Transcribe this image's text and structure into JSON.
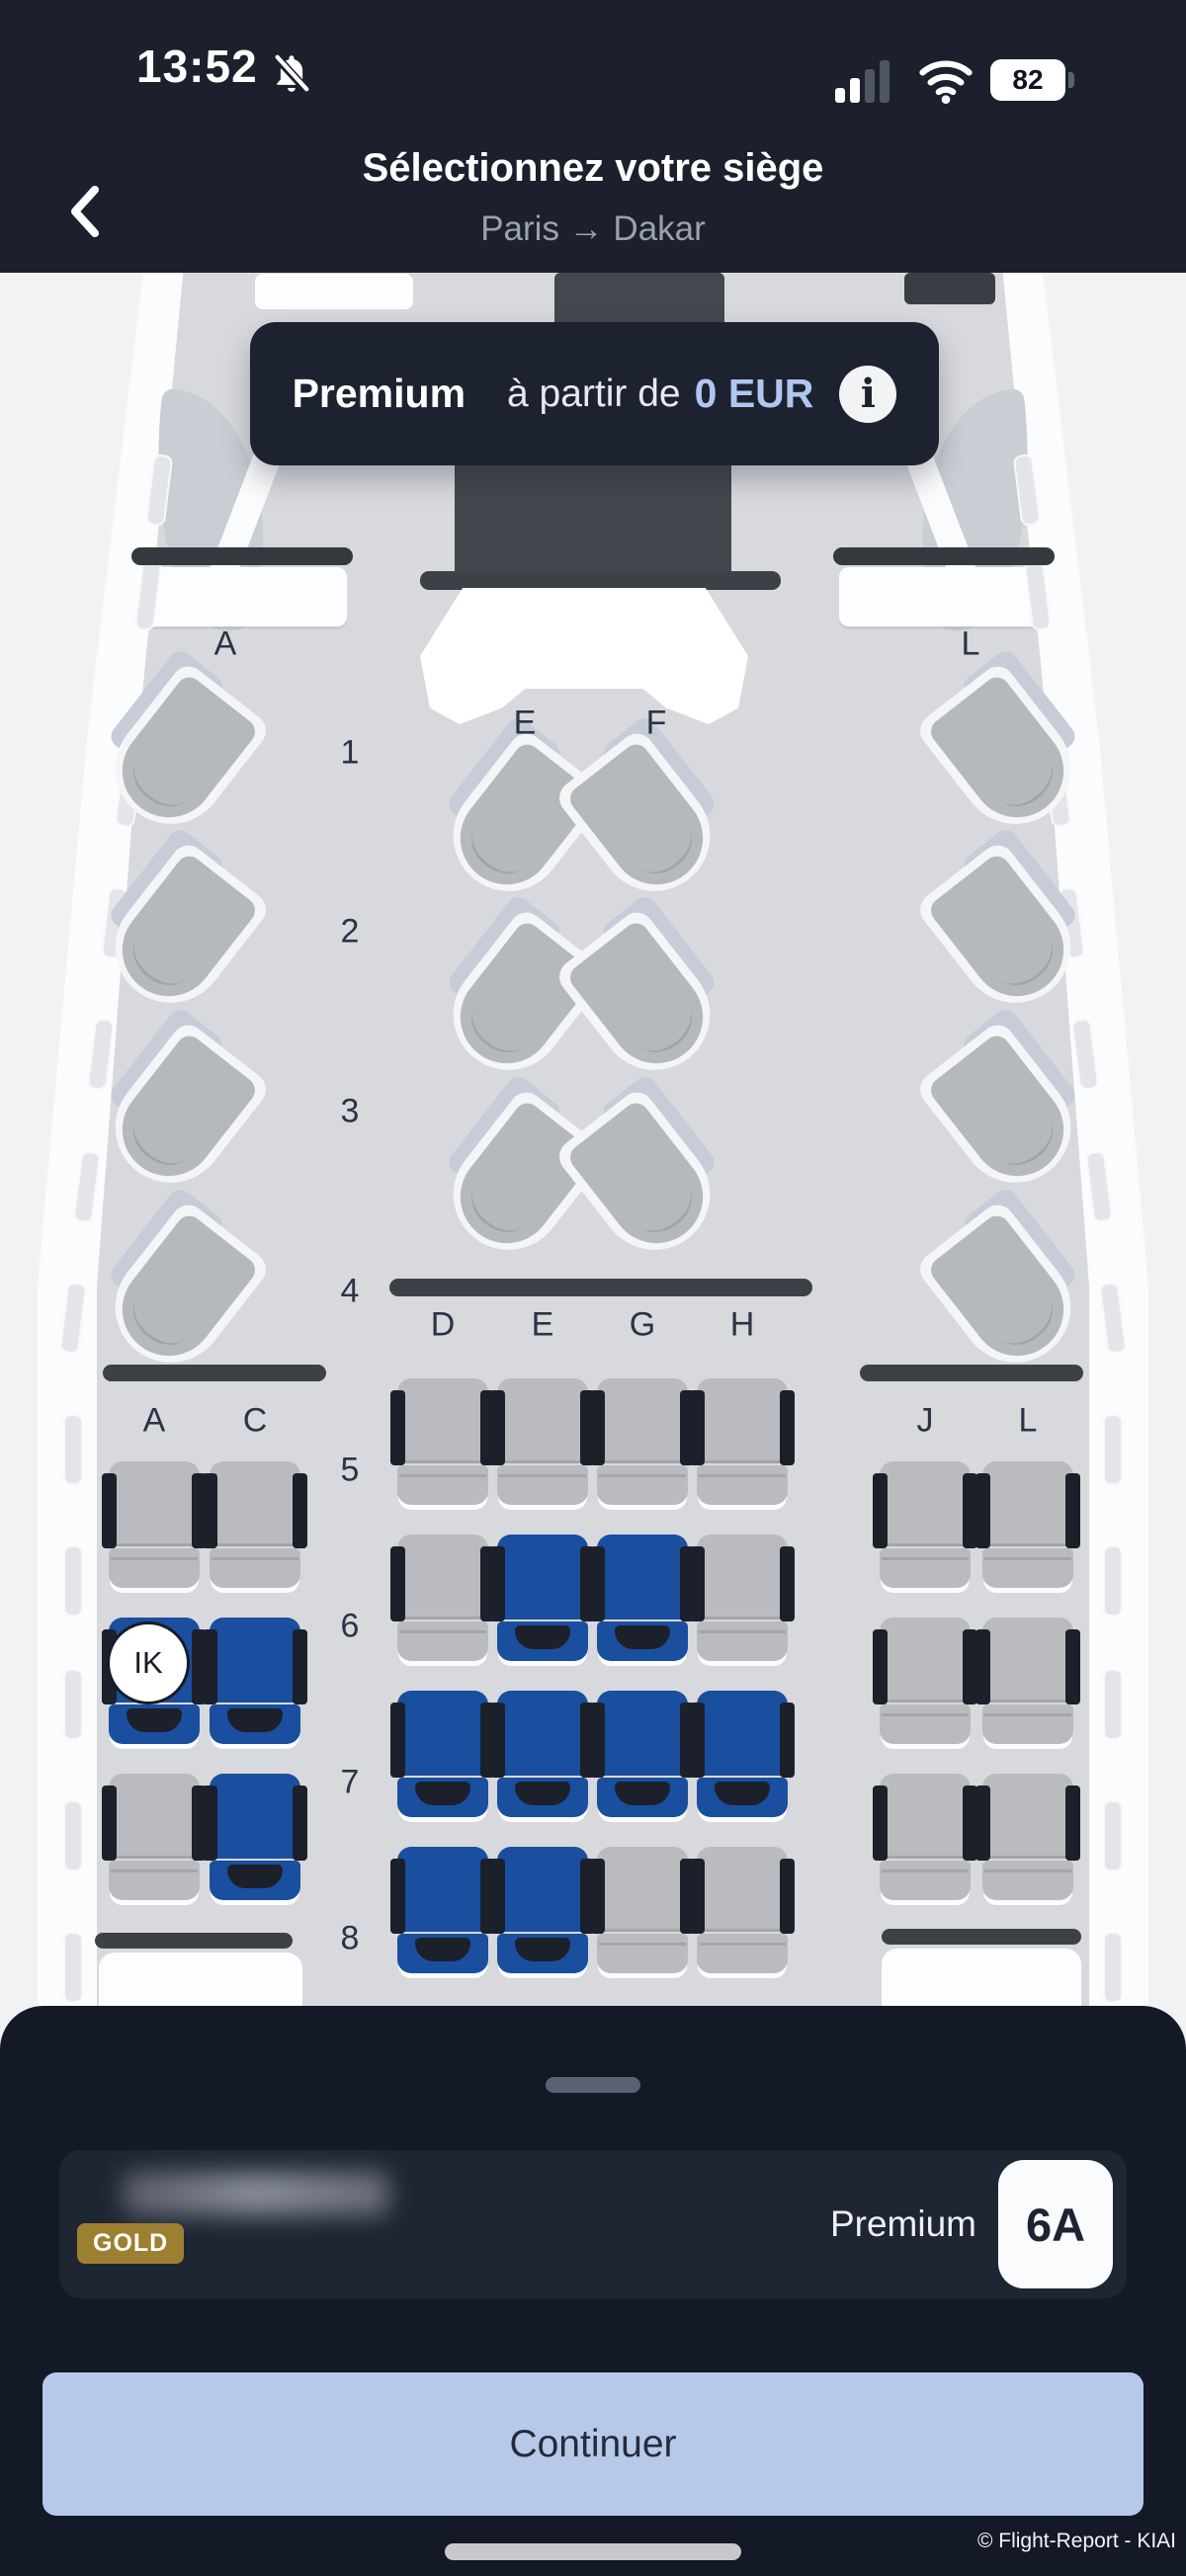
{
  "colors": {
    "header_bg": "#1b202c",
    "sheet_bg": "#141927",
    "card_bg": "#1e2533",
    "banner_bg": "#1d2230",
    "seat_available": "#1a4e9e",
    "seat_occupied": "#b9bbbe",
    "seat_dark": "#1b202b",
    "price_accent": "#b0c7ee",
    "gold_badge": "#9d7f31",
    "continue_bg": "#b7c9e9",
    "cabin": "#d7d9dd",
    "wall": "#fbfcfd",
    "exterior": "#f1f2f4",
    "divider": "#3d4147",
    "monument": "#44484e"
  },
  "status_bar": {
    "time": "13:52",
    "battery_level": "82",
    "icons": [
      "notifications-off-icon",
      "cellular-signal-icon",
      "wifi-icon",
      "battery-icon"
    ]
  },
  "header": {
    "back_icon": "chevron-left-icon",
    "title": "Sélectionnez votre siège",
    "route_from": "Paris",
    "route_arrow": "→",
    "route_to": "Dakar"
  },
  "banner": {
    "cabin_class": "Premium",
    "price_prefix": "à partir de",
    "price": "0 EUR",
    "info_icon": "info-icon",
    "info_glyph": "i"
  },
  "seatmap": {
    "business": {
      "left_label": "A",
      "center_labels": [
        "E",
        "F"
      ],
      "right_label": "L",
      "rows": [
        {
          "num": "1",
          "left": 1,
          "center": 1,
          "right": 1
        },
        {
          "num": "2",
          "left": 1,
          "center": 1,
          "right": 1
        },
        {
          "num": "3",
          "left": 1,
          "center": 1,
          "right": 1
        },
        {
          "num": "4",
          "left": 1,
          "center": 0,
          "right": 1
        }
      ]
    },
    "premium": {
      "left_labels": [
        "A",
        "C"
      ],
      "center_labels": [
        "D",
        "E",
        "G",
        "H"
      ],
      "right_labels": [
        "J",
        "L"
      ],
      "rows": [
        {
          "num": "5",
          "left": [
            "occupied",
            "occupied"
          ],
          "center": [
            "occupied",
            "occupied",
            "occupied",
            "occupied"
          ],
          "right": [
            "occupied",
            "occupied"
          ]
        },
        {
          "num": "6",
          "left": [
            "selected",
            "available"
          ],
          "center": [
            "occupied",
            "available",
            "available",
            "occupied"
          ],
          "right": [
            "occupied",
            "occupied"
          ]
        },
        {
          "num": "7",
          "left": [
            "occupied",
            "available"
          ],
          "center": [
            "available",
            "available",
            "available",
            "available"
          ],
          "right": [
            "occupied",
            "occupied"
          ]
        },
        {
          "num": "8",
          "left": null,
          "center": [
            "available",
            "available",
            "occupied",
            "occupied"
          ],
          "right": null
        }
      ],
      "selected_seat_badge": "IK"
    }
  },
  "bottom_sheet": {
    "passenger": {
      "tier_badge": "GOLD",
      "cabin_class": "Premium",
      "seat_number": "6A"
    },
    "continue_label": "Continuer"
  },
  "footer": {
    "credit": "© Flight-Report - KIAI"
  }
}
